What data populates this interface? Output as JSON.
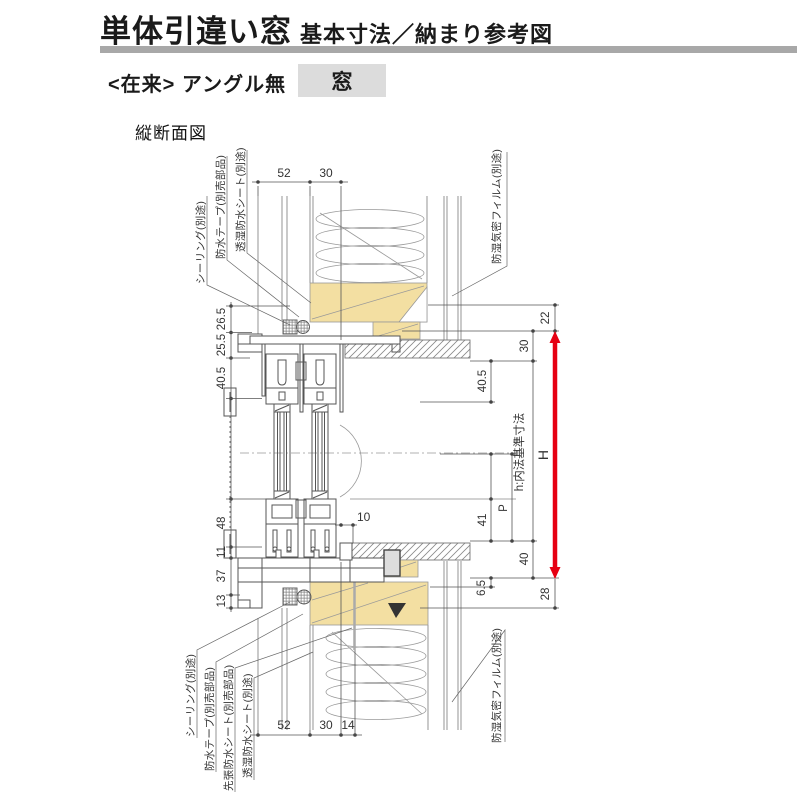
{
  "header": {
    "title": "単体引違い窓",
    "subtitle": "基本寸法／納まり参考図",
    "variant": "<在来> アングル無",
    "variant_tag": "窓",
    "section": "縦断面図"
  },
  "dims": {
    "top": [
      "52",
      "30"
    ],
    "bottom": [
      "52",
      "30",
      "14"
    ],
    "left": [
      "26.5",
      "25.5",
      "40.5",
      "48",
      "11",
      "37",
      "13"
    ],
    "right": {
      "d22": "22",
      "d30": "30",
      "d405": "40.5",
      "d41": "41",
      "p": "P",
      "d40": "40",
      "d65": "6.5",
      "d28": "28",
      "h_inner": "h:内法基準寸法",
      "height": "H"
    },
    "gap": "10"
  },
  "annotations": {
    "top_left": [
      "シーリング(別途)",
      "防水テープ(別売部品)",
      "透湿防水シート(別途)"
    ],
    "top_right": "防湿気密フィルム(別途)",
    "bottom_left": [
      "シーリング(別途)",
      "防水テープ(別売部品)",
      "先張防水シート(別売部品)",
      "透湿防水シート(別途)"
    ],
    "bottom_right": "防湿気密フィルム(別途)"
  },
  "colors": {
    "wood": "#f3dfa2",
    "arrow_red": "#e60012",
    "title_bar": "#a8a8a8",
    "tag_bg": "#dcdcdc"
  }
}
